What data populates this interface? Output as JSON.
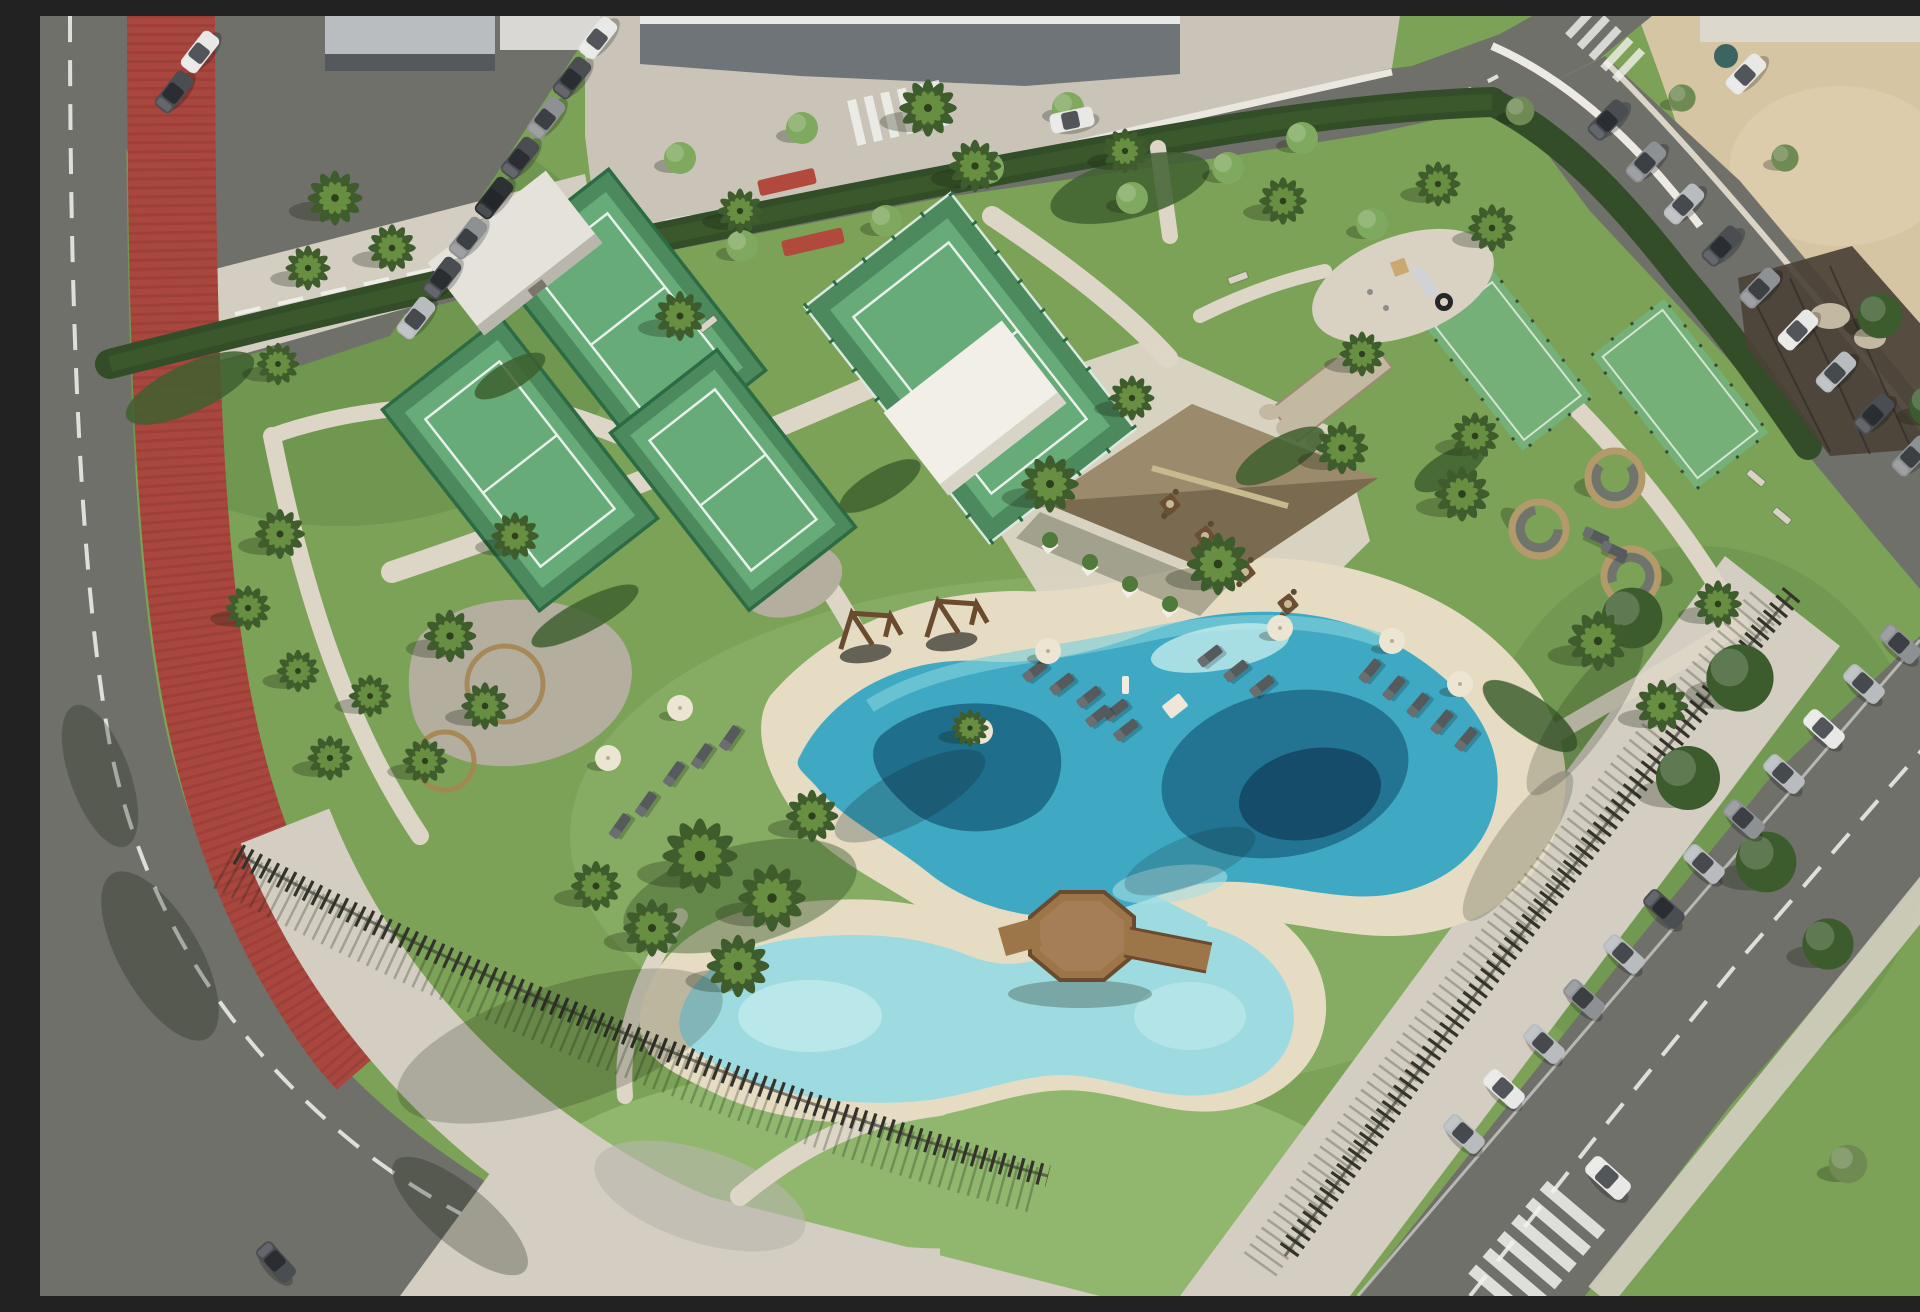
{
  "scene": {
    "title": "Aerial view - resort amenity park",
    "description": "Oblique aerial drone render of a coastal resort amenity park: four fenced padel courts, two lawn-sport courts, a lagoon-style main pool and a kids pool joined by a channel under an octagonal timber deck, a thatched-roof pool bar with white service annex, playground, circular privacy seating pods, sun loungers with cream parasols, palm trees, a red bike lane along the curving left road, timber picket fencing, and angled street parking full of cars beside a sandy lot.",
    "camera": "oblique aerial view, strong sunlight from upper right, long shadows to lower left",
    "inventory": {
      "padel_courts": 4,
      "lawn_sport_courts": 2,
      "swimming_pools": 2,
      "pool_deck": "octagonal timber deck with footbridge over connecting channel",
      "pool_bar_pavilion": "thatched hip roof with flat-roof white annex",
      "playground": "oval pad with slide, climber and tire",
      "privacy_seating_pods": 3,
      "wooden_swing_frames": 2,
      "fire_pit_dining_sets": 4,
      "picnic_bench_circles": 2,
      "sun_loungers": "approx 25",
      "parasols": "approx 8",
      "parked_cars": "approx 34",
      "palm_trees": "approx 36",
      "red_bike_lane": true,
      "timber_picket_fence": true,
      "sandy_lot_top_right": true
    }
  },
  "palette": {
    "grass": "#7ba257",
    "grassLight": "#93b971",
    "grassDark": "#5c8544",
    "sand": "#d6c5a3",
    "sandLight": "#e2d4b6",
    "road": "#6f706a",
    "line": "#f2f2ee",
    "redLane": "#a9473f",
    "redLaneDark": "#7e2f2a",
    "sidewalk": "#d3cec1",
    "plaza": "#c9c4b7",
    "path": "#ddd6c6",
    "gravel": "#b4ae9f",
    "hedge": "#324d27",
    "hedgeLight": "#41632f",
    "palmDark": "#3f5c2c",
    "palmLight": "#6d9444",
    "treeStreet": "#7fa95e",
    "treeFicus": "#3c5c2e",
    "treeOlive": "#6f8a52",
    "courtOut": "#4c8a5d",
    "courtIn": "#66ab78",
    "courtLine": "#e8f2ea",
    "courtFence": "#2c6b43",
    "glass": "#d8e9e1",
    "waterDeep": "#175f7e",
    "waterNavy": "#123f5c",
    "waterMid": "#3fa9c4",
    "waterLight": "#7fd0da",
    "waterPale": "#c2ebec",
    "waterKids": "#9edbe1",
    "beach": "#e6dcc4",
    "wood": "#9c7648",
    "woodDark": "#6b4b2e",
    "thatch": "#8d7c5e",
    "thatchLight": "#9b8b6c",
    "thatchDark": "#77684e",
    "ridge": "#c9b98f",
    "white": "#f1efe8",
    "hutRoof": "#e4e2da",
    "hutWall": "#b9b6ad",
    "stone": "#c3b8a2",
    "fence": "#33332c",
    "carWhite": "#e8e8e6",
    "carSilver": "#b9bcbf",
    "carGray": "#8e9194",
    "carDark": "#4a4d52",
    "carBlack": "#2e3134",
    "red": "#b2493d",
    "umbrella": "#ece5d2",
    "lounger": "#565a5c"
  }
}
